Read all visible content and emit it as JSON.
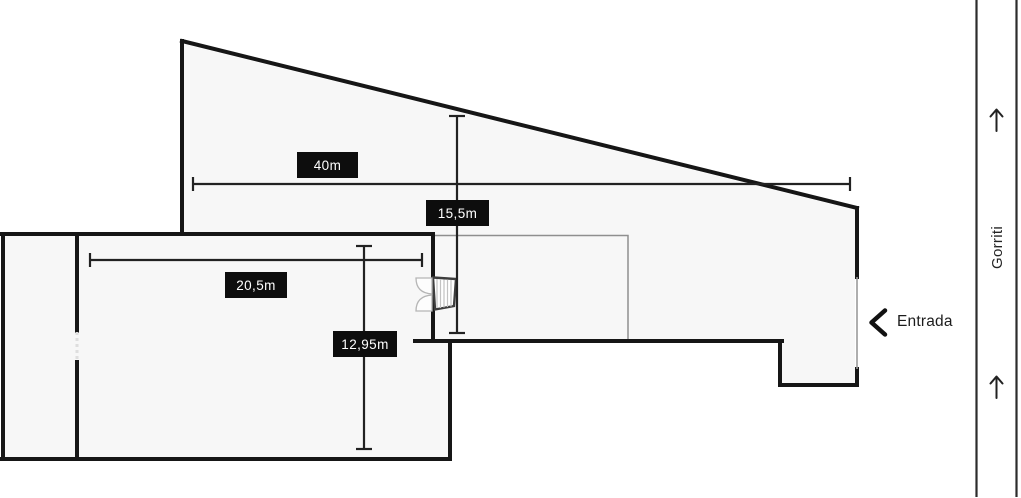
{
  "floorplan": {
    "dimensions": {
      "upper_width": {
        "label": "40m"
      },
      "upper_depth": {
        "label": "15,5m"
      },
      "lower_width": {
        "label": "20,5m"
      },
      "lower_depth": {
        "label": "12,95m"
      }
    },
    "entrance": {
      "label": "Entrada"
    },
    "street": {
      "name": "Gorriti"
    },
    "icons": {
      "entrance": "chevron-left",
      "street_direction_top": "arrow-up",
      "street_direction_bottom": "arrow-up",
      "stairs": "stairs-hatch",
      "door": "double-swing-door"
    },
    "colors": {
      "wall": "#161616",
      "interior_fill": "#f7f7f7",
      "thin_line": "#8f8f8f",
      "dimension_line": "#222222",
      "label_bg": "#0d0d0d",
      "label_text": "#ffffff",
      "background": "#ffffff"
    }
  }
}
